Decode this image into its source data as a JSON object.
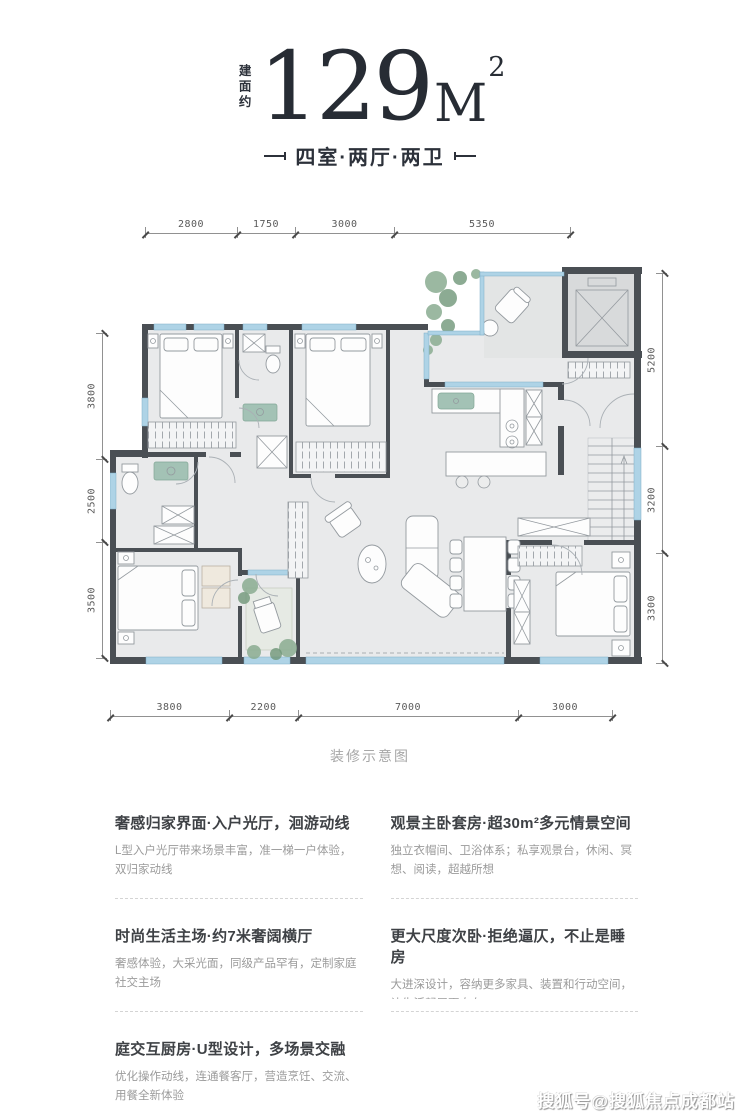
{
  "header": {
    "area_prefix": "建面约",
    "area_value": "129",
    "area_unit": "M",
    "area_sup": "2",
    "layout_label": "四室·两厅·两卫"
  },
  "plan": {
    "caption": "装修示意图",
    "dims": {
      "top": [
        "2800",
        "1750",
        "3000",
        "5350"
      ],
      "bottom": [
        "3800",
        "2200",
        "7000",
        "3000"
      ],
      "left": [
        "3800",
        "2500",
        "3500"
      ],
      "right": [
        "5200",
        "3200",
        "3300"
      ]
    }
  },
  "features": [
    {
      "title": "奢感归家界面·入户光厅，洄游动线",
      "body": "L型入户光厅带来场景丰富，准一梯一户体验，双归家动线"
    },
    {
      "title": "观景主卧套房·超30m²多元情景空间",
      "body": "独立衣帽间、卫浴体系；私享观景台，休闲、冥想、阅读，超越所想"
    },
    {
      "title": "时尚生活主场·约7米奢阔横厅",
      "body": "奢感体验，大采光面，同级产品罕有，定制家庭社交主场"
    },
    {
      "title": "更大尺度次卧·拒绝逼仄，不止是睡房",
      "body": "大进深设计，容纳更多家具、装置和行动空间，让生活起居更自在"
    },
    {
      "title": "庭交互厨房·U型设计，多场景交融",
      "body": "优化操作动线，连通餐客厅，营造烹饪、交流、用餐全新体验"
    }
  ],
  "watermark": "搜狐号@搜狐焦点成都站",
  "colors": {
    "wall": "#4a4f54",
    "window": "#aed3e6",
    "floor": "#e9eaeb",
    "plant": "#8aab90",
    "text_dark": "#2c313a",
    "text_gray": "#9b9b9b"
  }
}
